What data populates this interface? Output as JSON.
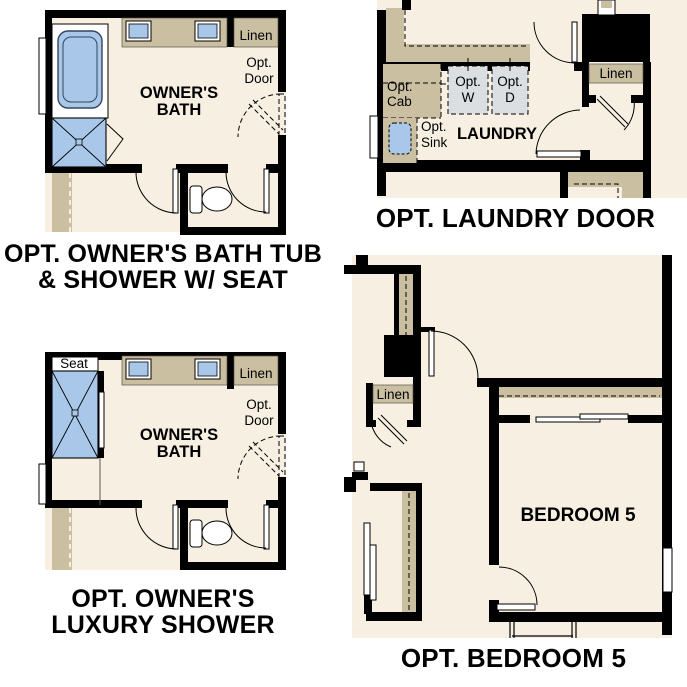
{
  "colors": {
    "wall": "#000000",
    "floor": "#f7f0e2",
    "counter": "#cbbfa2",
    "fixture_blue": "#a9c8e9",
    "appliance_gray": "#dcdfe2",
    "background": "#ffffff",
    "text": "#000000"
  },
  "panels": {
    "owners_bath_tub": {
      "caption": "OPT. OWNER'S BATH TUB\n& SHOWER W/ SEAT",
      "labels": {
        "room": [
          "OWNER'S",
          "BATH"
        ],
        "linen": "Linen",
        "opt_door": [
          "Opt.",
          "Door"
        ]
      }
    },
    "laundry": {
      "caption": "OPT. LAUNDRY DOOR",
      "labels": {
        "room": "LAUNDRY",
        "linen": "Linen",
        "opt_cab": [
          "Opt.",
          "Cab"
        ],
        "opt_w": [
          "Opt.",
          "W"
        ],
        "opt_d": [
          "Opt.",
          "D"
        ],
        "opt_sink": [
          "Opt.",
          "Sink"
        ]
      }
    },
    "luxury_shower": {
      "caption": "OPT. OWNER'S\nLUXURY SHOWER",
      "labels": {
        "room": [
          "OWNER'S",
          "BATH"
        ],
        "linen": "Linen",
        "opt_door": [
          "Opt.",
          "Door"
        ],
        "seat": "Seat"
      }
    },
    "bedroom5": {
      "caption": "OPT. BEDROOM 5",
      "labels": {
        "room": "BEDROOM 5",
        "linen": "Linen"
      }
    }
  }
}
